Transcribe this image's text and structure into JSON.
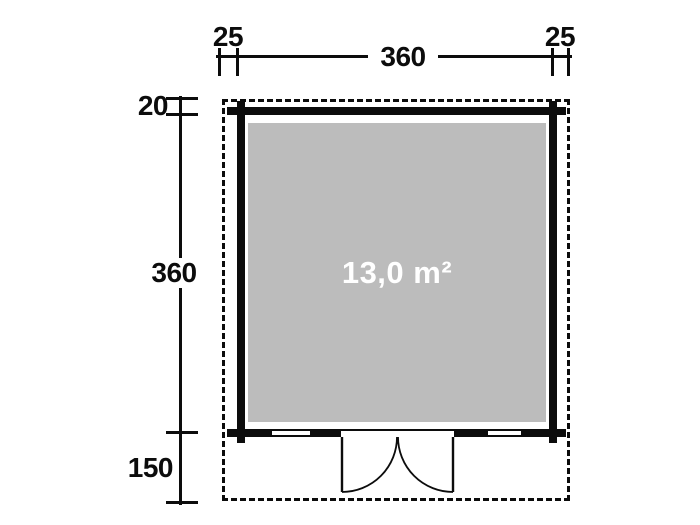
{
  "diagram": {
    "type": "floor-plan",
    "area_label": "13,0 m²",
    "dimensions": {
      "top_left_offset": "25",
      "top_width": "360",
      "top_right_offset": "25",
      "side_top_offset": "20",
      "side_depth": "360",
      "side_front": "150"
    },
    "colors": {
      "background": "#ffffff",
      "line": "#0c0c0c",
      "floor_fill": "#bcbcbc",
      "area_text": "#ffffff"
    }
  }
}
